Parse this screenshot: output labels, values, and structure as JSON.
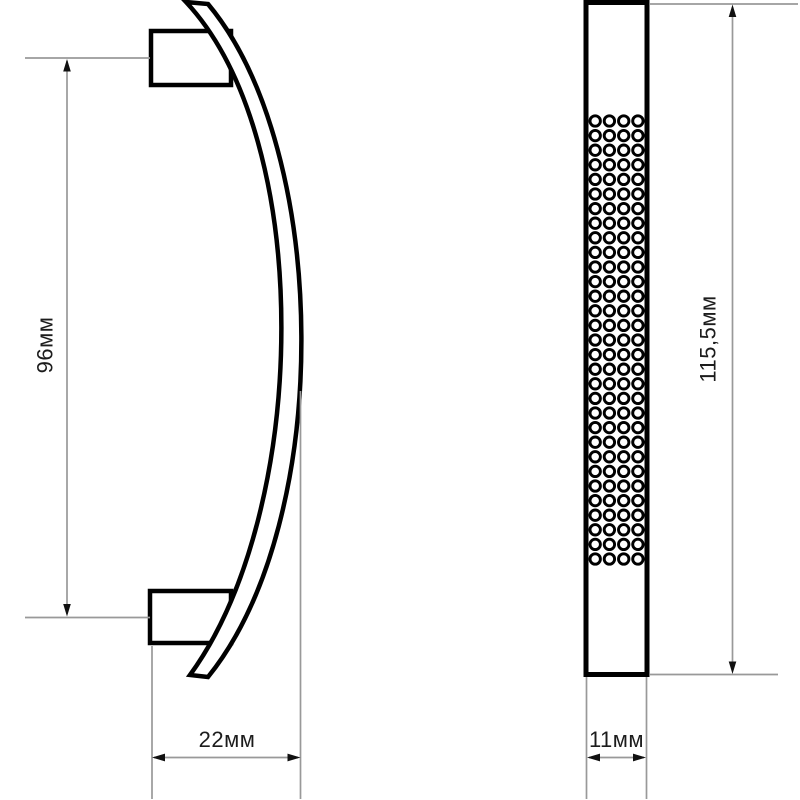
{
  "drawing": {
    "type": "technical-dimension-drawing",
    "subject": "curved furniture pull handle, side profile and front face views",
    "side_view": {
      "height_label": "96мм",
      "width_label": "22мм"
    },
    "front_view": {
      "height_label": "115,5мм",
      "width_label": "11мм",
      "texture": {
        "rows": 31,
        "cols": 4
      }
    },
    "colors": {
      "outline": "#000000",
      "dimension_line": "#999999",
      "label_text": "#1c1c1c",
      "background": "#ffffff"
    }
  }
}
